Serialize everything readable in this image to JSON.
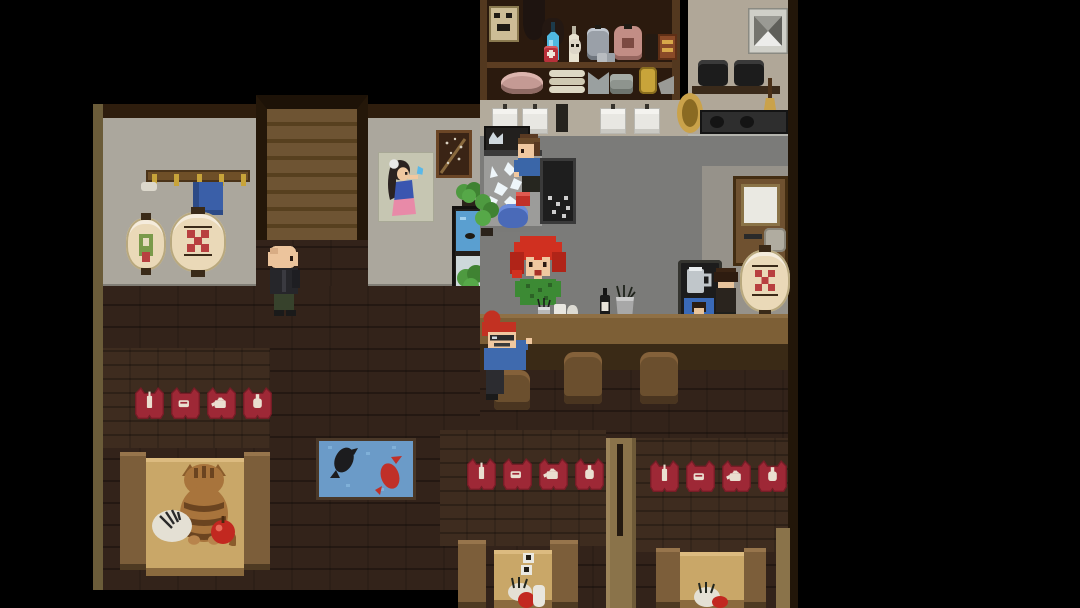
{
  "meta": {
    "app": "pixel-art-tavern-game",
    "scene_description": "Top-down pixel-art izakaya/tavern interior: back bar with shelves of bottles and plates, kitchen with stove and pot rack, red-haired bartender in green shirt, staff washing dishes at a sink, customer with glasses seated at the bar counter, bald customer walking on the wooden floor, cat sitting on a booth table, koi fish rug, red pennant banners with drink icons over three booth areas, wooden staircase, coat rack, paper lanterns, pin-up poster and a back door."
  },
  "palette": {
    "bg": "#000000",
    "wall_gray": "#aba79d",
    "wall_beige": "#b3ab9c",
    "kitchen_floor": "#7b7b79",
    "wood_floor": "#33231a",
    "booth_wall": "#3e2c1f",
    "beam": "#2e1d0d",
    "edge_olive": "#6b5c39",
    "pillar_tan": "#8a734a",
    "stair_light": "#6e5433",
    "stair_dark": "#57401f",
    "counter_top": "#7d5f36",
    "counter_front": "#3a2a16",
    "table_tan": "#c9a768",
    "bench": "#7c5e3a",
    "stool": "#6b4f2e",
    "banner_red": "#9e2836",
    "banner_red_dark": "#771c26",
    "banner_icon": "#eadfd0",
    "rug_blue": "#6b9bc8",
    "koi_black": "#1c1c1e",
    "koi_red": "#c03028",
    "door_brown": "#6f5130",
    "lantern_cream": "#ead9b8",
    "lantern_red": "#b84040",
    "lantern_green": "#7a9a4a",
    "hair_red": "#d03020",
    "hair_brown": "#5a3a22",
    "shirt_green": "#3c8a34",
    "shirt_blue": "#3a66a8",
    "skin": "#f0c8a0",
    "plant_green": "#4e9a40",
    "water_blue": "#5a9fd0"
  },
  "banners": {
    "icons": [
      "bottle",
      "cup",
      "kettle",
      "jug"
    ],
    "rows": 3
  },
  "characters": [
    {
      "id": "dishwasher",
      "desc": "brown-haired staff washing dishes at the sink"
    },
    {
      "id": "bartender",
      "desc": "red-haired bartender in green shirt behind the bar"
    },
    {
      "id": "seated-customer",
      "desc": "red-haired customer with glasses on a bar stool"
    },
    {
      "id": "bald-customer",
      "desc": "bald customer in dark jacket crossing the floor"
    },
    {
      "id": "corner-patron",
      "desc": "dark-haired patron at the right end of the bar"
    },
    {
      "id": "cat",
      "desc": "brown tabby cat sitting on the left booth table"
    }
  ],
  "fixtures": [
    "back-bar shelves (bottles, jars, sacks, plates, bowls)",
    "ice bins on prep counter",
    "sink with splashing water",
    "dish rack",
    "kitchen stove and cabinets",
    "pot shelf with pans",
    "broom",
    "wall vent",
    "staircase",
    "coat rack with gold hooks",
    "blue towel",
    "paper lanterns (floral and checkered)",
    "pin-up poster",
    "framed picture",
    "potted plants",
    "small aquarium",
    "back door with frosted window",
    "door sign",
    "menu stand with mug picture",
    "bar counter with three stools",
    "left booth with cat / fish dish / apple",
    "koi fish rug",
    "middle booth table with menu tags, dish, jug",
    "right booth table with fish dish",
    "three rows of four red pennant banners"
  ]
}
